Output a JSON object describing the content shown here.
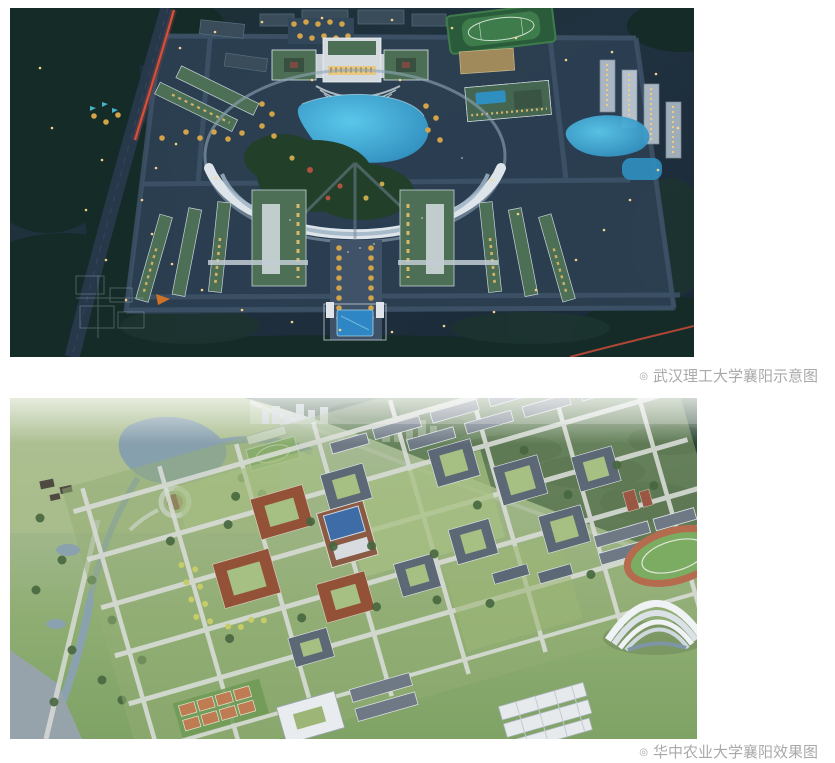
{
  "page": {
    "background_color": "#ffffff"
  },
  "figures": [
    {
      "marker": "◎",
      "caption": "武汉理工大学襄阳示意图"
    },
    {
      "marker": "◎",
      "caption": "华中农业大学襄阳效果图"
    }
  ],
  "caption_style": {
    "color": "#a9a9a9",
    "font_size_px": 15
  },
  "palette": {
    "night_sky": "#1f3140",
    "night_forest": "#152b28",
    "night_road": "#27384a",
    "red_light_trail": "#e2503a",
    "lake_cyan": "#45b9e4",
    "roof_green_night": "#4d6f56",
    "warm_window_light": "#ecc06c",
    "arc_building_white": "#dde5ea",
    "day_haze": "#ffffff",
    "day_forest": "#2f4a38",
    "day_lawn": "#8ead72",
    "day_road": "#d8dcd6",
    "day_roof_slate": "#5d6876",
    "brick_red": "#935238",
    "library_blue_roof": "#3e6ca6",
    "track_red": "#b56b4e",
    "water_gray_blue": "#8aa2ae",
    "court_orange": "#bf7b51",
    "gym_shell_white": "#f0f3f5"
  }
}
